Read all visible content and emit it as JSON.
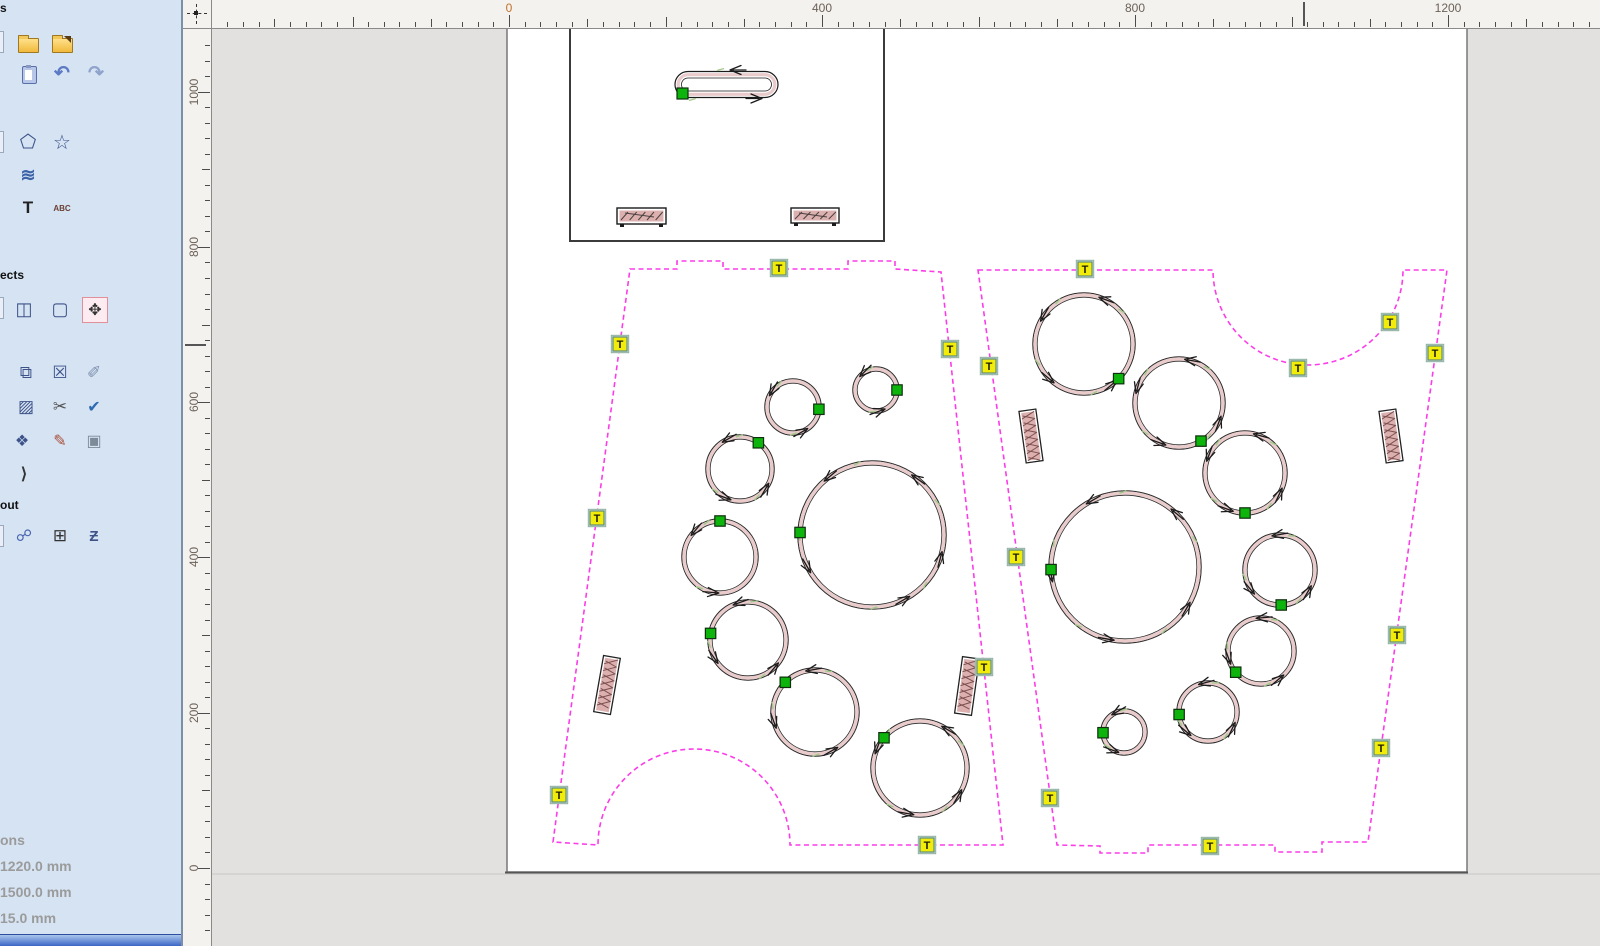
{
  "sidebar": {
    "header_files": "s",
    "header_effects": "ects",
    "header_layout": "out",
    "info": {
      "line0": "ons",
      "line1": "1220.0 mm",
      "line2": "1500.0 mm",
      "line3": "15.0 mm"
    },
    "icons": [
      {
        "name": "new-file-icon",
        "kind": "sliver",
        "x": -12,
        "y": 31
      },
      {
        "name": "open-file-icon",
        "kind": "folder",
        "x": 16,
        "y": 31
      },
      {
        "name": "import-file-icon",
        "kind": "folder-import",
        "x": 50,
        "y": 31
      },
      {
        "name": "paste-icon",
        "kind": "clipboard",
        "x": 17,
        "y": 63
      },
      {
        "name": "undo-icon",
        "kind": "glyph",
        "glyph": "↶",
        "color": "#5b79c4",
        "size": 19,
        "bold": true,
        "x": 50,
        "y": 61
      },
      {
        "name": "redo-icon",
        "kind": "glyph",
        "glyph": "↷",
        "color": "#8fa3cc",
        "size": 19,
        "bold": true,
        "x": 84,
        "y": 61
      },
      {
        "name": "shape-tool-icon",
        "kind": "sliver",
        "x": -12,
        "y": 131
      },
      {
        "name": "pentagon-tool-icon",
        "kind": "glyph",
        "glyph": "⬠",
        "color": "#3d5288",
        "size": 19,
        "bold": false,
        "x": 16,
        "y": 130
      },
      {
        "name": "star-tool-icon",
        "kind": "glyph",
        "glyph": "☆",
        "color": "#3d5288",
        "size": 20,
        "bold": false,
        "x": 50,
        "y": 130
      },
      {
        "name": "spiral-tool-icon",
        "kind": "glyph",
        "glyph": "≋",
        "color": "#3c63a8",
        "size": 18,
        "bold": true,
        "x": 16,
        "y": 163
      },
      {
        "name": "text-tool-icon",
        "kind": "glyph",
        "glyph": "T",
        "color": "#222222",
        "size": 17,
        "bold": true,
        "x": 16,
        "y": 196
      },
      {
        "name": "arc-text-tool-icon",
        "kind": "glyph",
        "glyph": "ABC",
        "color": "#6a3f35",
        "size": 8,
        "bold": true,
        "x": 50,
        "y": 196
      },
      {
        "name": "effect-extra-icon",
        "kind": "sliver",
        "x": -12,
        "y": 297
      },
      {
        "name": "flip-icon",
        "kind": "glyph",
        "glyph": "◫",
        "color": "#3d5288",
        "size": 18,
        "bold": false,
        "x": 12,
        "y": 297
      },
      {
        "name": "distort-icon",
        "kind": "glyph",
        "glyph": "▢",
        "color": "#3d5288",
        "size": 18,
        "bold": false,
        "x": 48,
        "y": 297
      },
      {
        "name": "center-move-icon",
        "kind": "glyph",
        "glyph": "✥",
        "color": "#333333",
        "size": 16,
        "bold": false,
        "highlight": true,
        "x": 82,
        "y": 297
      },
      {
        "name": "clone-icon",
        "kind": "glyph",
        "glyph": "⧉",
        "color": "#3d5288",
        "size": 17,
        "bold": false,
        "x": 14,
        "y": 361
      },
      {
        "name": "delete-clone-icon",
        "kind": "glyph",
        "glyph": "☒",
        "color": "#3d5288",
        "size": 17,
        "bold": false,
        "x": 48,
        "y": 361
      },
      {
        "name": "measure-icon",
        "kind": "glyph",
        "glyph": "✐",
        "color": "#7d8fae",
        "size": 17,
        "bold": false,
        "x": 82,
        "y": 361
      },
      {
        "name": "hatch-fill-icon",
        "kind": "glyph",
        "glyph": "▨",
        "color": "#3d5288",
        "size": 17,
        "bold": false,
        "x": 14,
        "y": 395
      },
      {
        "name": "cut-path-icon",
        "kind": "glyph",
        "glyph": "✂",
        "color": "#555555",
        "size": 17,
        "bold": false,
        "x": 48,
        "y": 395
      },
      {
        "name": "check-icon",
        "kind": "glyph",
        "glyph": "✔",
        "color": "#2e6bb0",
        "size": 16,
        "bold": false,
        "x": 82,
        "y": 395
      },
      {
        "name": "node-edit-icon",
        "kind": "glyph",
        "glyph": "❖",
        "color": "#3d5288",
        "size": 16,
        "bold": false,
        "x": 10,
        "y": 429
      },
      {
        "name": "draw-edit-icon",
        "kind": "glyph",
        "glyph": "✎",
        "color": "#a84c35",
        "size": 16,
        "bold": false,
        "x": 48,
        "y": 429
      },
      {
        "name": "image-icon",
        "kind": "glyph",
        "glyph": "▣",
        "color": "#7d8a98",
        "size": 16,
        "bold": false,
        "x": 82,
        "y": 429
      },
      {
        "name": "polyline-icon",
        "kind": "glyph",
        "glyph": "⟩",
        "color": "#333333",
        "size": 16,
        "bold": true,
        "x": 12,
        "y": 462
      },
      {
        "name": "layout-extra-icon",
        "kind": "sliver",
        "x": -12,
        "y": 525
      },
      {
        "name": "link-nodes-icon",
        "kind": "glyph",
        "glyph": "☍",
        "color": "#4a66b0",
        "size": 16,
        "bold": false,
        "x": 12,
        "y": 524
      },
      {
        "name": "array-grid-icon",
        "kind": "glyph",
        "glyph": "⊞",
        "color": "#333333",
        "size": 17,
        "bold": false,
        "x": 48,
        "y": 524
      },
      {
        "name": "nest-icon",
        "kind": "glyph",
        "glyph": "Ƶ",
        "color": "#3d5288",
        "size": 15,
        "bold": true,
        "x": 82,
        "y": 524
      }
    ]
  },
  "rulers": {
    "h": {
      "origin_px": 509,
      "px_per_mm": 0.7825,
      "min_mm": -360,
      "max_mm": 1380,
      "minor_step_mm": 20,
      "label_step_mm": 400,
      "labels": [
        "0",
        "400",
        "800",
        "1200"
      ],
      "cursor_px": 1303,
      "zero_color": "#c0722a"
    },
    "v": {
      "origin_px": 868,
      "px_per_mm": 0.7763,
      "min_mm": -100,
      "max_mm": 1080,
      "minor_step_mm": 20,
      "label_step_mm": 200,
      "labels": [
        "0",
        "200",
        "400",
        "600",
        "800",
        "1000"
      ],
      "cursor_px": 344
    }
  },
  "canvas": {
    "colors": {
      "magenta": "#fb3ce8",
      "tab_fill": "#f2ec0a",
      "tab_border": "#5e8d7d",
      "tab_text": "#1c1c00",
      "node_fill": "#0cb40c",
      "node_border": "#0f2f0f",
      "kerf": "#e9cbcb",
      "outline": "#2b2b2b",
      "slot_fill": "#ddb0b0",
      "hatch": "#7c4f4f",
      "sheet_border": "#6f6f6f",
      "sheet_bottom": "#555555",
      "part_border": "#3b3b3b",
      "canvas_line": "#c8c8c6",
      "green_tick": "#a3c98b"
    },
    "tab_letter": "T",
    "sheet": {
      "x": 507,
      "y": -60,
      "w": 960,
      "h": 932
    },
    "part_rect": {
      "x": 570,
      "y": -60,
      "w": 314,
      "h": 301
    },
    "obround": {
      "x": 675,
      "y": 71.5,
      "w": 103,
      "h": 26,
      "node": {
        "x": 677,
        "y": 88,
        "s": 11
      },
      "arrows": [
        {
          "x": 732,
          "y": 70,
          "dir": 180
        },
        {
          "x": 760,
          "y": 98.5,
          "dir": 0
        }
      ]
    },
    "mini_rects": [
      {
        "x": 617,
        "y": 208,
        "w": 49,
        "h": 16
      },
      {
        "x": 791,
        "y": 208,
        "w": 48,
        "h": 15
      }
    ],
    "polygons": [
      {
        "name": "nested-part-left",
        "path": "M630,269 L677,269 L677,261 L723,261 L723,269 L848,269 L848,261 L895,261 L895,269 L941,272 L1003,845 L790,845 A96,96 0 0 0 598,845 L553,842 Z",
        "tabs": [
          [
            779,
            268
          ],
          [
            620,
            344
          ],
          [
            597,
            518
          ],
          [
            559,
            795
          ],
          [
            950,
            349
          ],
          [
            984,
            667
          ],
          [
            927,
            845
          ]
        ]
      },
      {
        "name": "nested-part-right",
        "path": "M978,270 L1213,270 A95,95 0 0 0 1403,270 L1447,270 L1368,842 L1322,842 L1322,852 L1275,852 L1275,845 L1148,845 L1148,853 L1100,853 L1100,846 L1057,845 Z",
        "tabs": [
          [
            1085,
            269
          ],
          [
            1298,
            368
          ],
          [
            1390,
            322
          ],
          [
            1435,
            353
          ],
          [
            1397,
            635
          ],
          [
            1381,
            748
          ],
          [
            989,
            366
          ],
          [
            1016,
            557
          ],
          [
            1050,
            798
          ],
          [
            1210,
            846
          ]
        ]
      }
    ],
    "circles": [
      {
        "cx": 793,
        "cy": 407,
        "r": 26,
        "node": 355,
        "arrows": [
          150,
          300
        ]
      },
      {
        "cx": 876,
        "cy": 390,
        "r": 21,
        "node": 0,
        "arrows": [
          135,
          290
        ]
      },
      {
        "cx": 740,
        "cy": 469,
        "r": 32,
        "node": 55,
        "arrows": [
          120,
          250,
          330
        ]
      },
      {
        "cx": 720,
        "cy": 557,
        "r": 36,
        "node": 90,
        "arrows": [
          140,
          265
        ]
      },
      {
        "cx": 872,
        "cy": 535,
        "r": 72,
        "node": 178,
        "arrows": [
          55,
          130,
          210,
          300,
          345
        ]
      },
      {
        "cx": 748,
        "cy": 640,
        "r": 38,
        "node": 170,
        "arrows": [
          110,
          215,
          320
        ]
      },
      {
        "cx": 815,
        "cy": 712,
        "r": 42,
        "node": 135,
        "arrows": [
          100,
          200,
          300
        ]
      },
      {
        "cx": 920,
        "cy": 768,
        "r": 47,
        "node": 140,
        "arrows": [
          60,
          160,
          260,
          330
        ]
      },
      {
        "cx": 1084,
        "cy": 344,
        "r": 49,
        "node": 315,
        "arrows": [
          70,
          150,
          230,
          310
        ]
      },
      {
        "cx": 1179,
        "cy": 403,
        "r": 44,
        "node": 300,
        "arrows": [
          80,
          165,
          250,
          340
        ]
      },
      {
        "cx": 1245,
        "cy": 473,
        "r": 40,
        "node": 270,
        "arrows": [
          75,
          160,
          250,
          335
        ]
      },
      {
        "cx": 1125,
        "cy": 567,
        "r": 74,
        "node": 182,
        "arrows": [
          50,
          120,
          190,
          260,
          330
        ]
      },
      {
        "cx": 1280,
        "cy": 570,
        "r": 35,
        "node": 272,
        "arrows": [
          100,
          220,
          330
        ]
      },
      {
        "cx": 1261,
        "cy": 651,
        "r": 33,
        "node": 220,
        "arrows": [
          95,
          200,
          310
        ]
      },
      {
        "cx": 1208,
        "cy": 712,
        "r": 29,
        "node": 185,
        "arrows": [
          105,
          230,
          335
        ]
      },
      {
        "cx": 1124,
        "cy": 732,
        "r": 21,
        "node": 182,
        "arrows": [
          120,
          250
        ]
      }
    ],
    "slots": [
      {
        "cx": 607,
        "cy": 685,
        "w": 17,
        "h": 57,
        "rot": 10
      },
      {
        "cx": 967,
        "cy": 686,
        "w": 17,
        "h": 57,
        "rot": 8
      },
      {
        "cx": 1031,
        "cy": 436,
        "w": 17,
        "h": 52,
        "rot": -8
      },
      {
        "cx": 1391,
        "cy": 436,
        "w": 17,
        "h": 52,
        "rot": -8
      }
    ]
  }
}
